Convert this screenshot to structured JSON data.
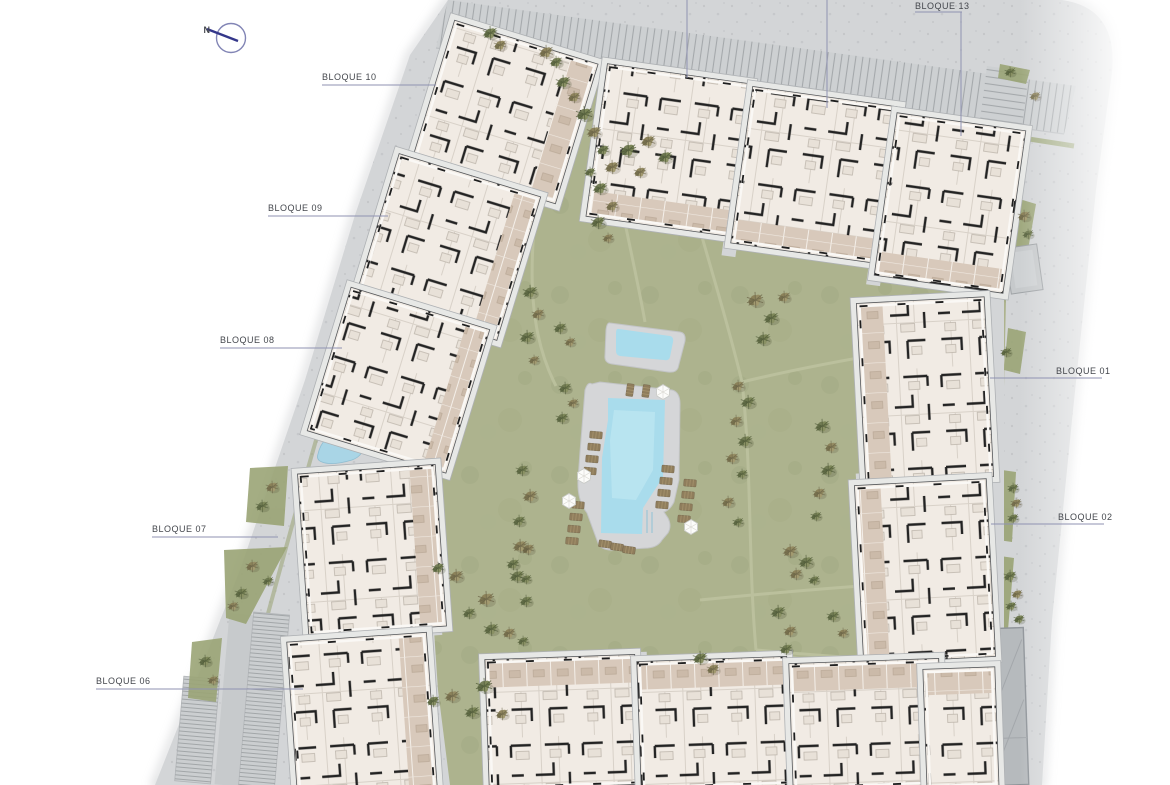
{
  "compass": {
    "label": "N"
  },
  "block_labels": [
    {
      "id": "bloque-10",
      "text": "BLOQUE 10"
    },
    {
      "id": "bloque-09",
      "text": "BLOQUE 09"
    },
    {
      "id": "bloque-08",
      "text": "BLOQUE 08"
    },
    {
      "id": "bloque-07",
      "text": "BLOQUE 07"
    },
    {
      "id": "bloque-06",
      "text": "BLOQUE 06"
    },
    {
      "id": "bloque-13",
      "text": "BLOQUE 13"
    },
    {
      "id": "bloque-01",
      "text": "BLOQUE 01"
    },
    {
      "id": "bloque-02",
      "text": "BLOQUE 02"
    }
  ],
  "colors": {
    "road": "#d3d5d7",
    "lawn": "#adb38e",
    "water": "#a9dcec",
    "pool_deck": "#d5d6d8",
    "building_base": "#f1ebe4",
    "building_wall": "#232323",
    "terrace": "#d8c9bb",
    "hedge": "#96a06e",
    "parking_hatch": "#a4a8ab",
    "label_text": "#44474d",
    "leader_line": "#8f92b2",
    "compass_needle": "#34378a"
  }
}
